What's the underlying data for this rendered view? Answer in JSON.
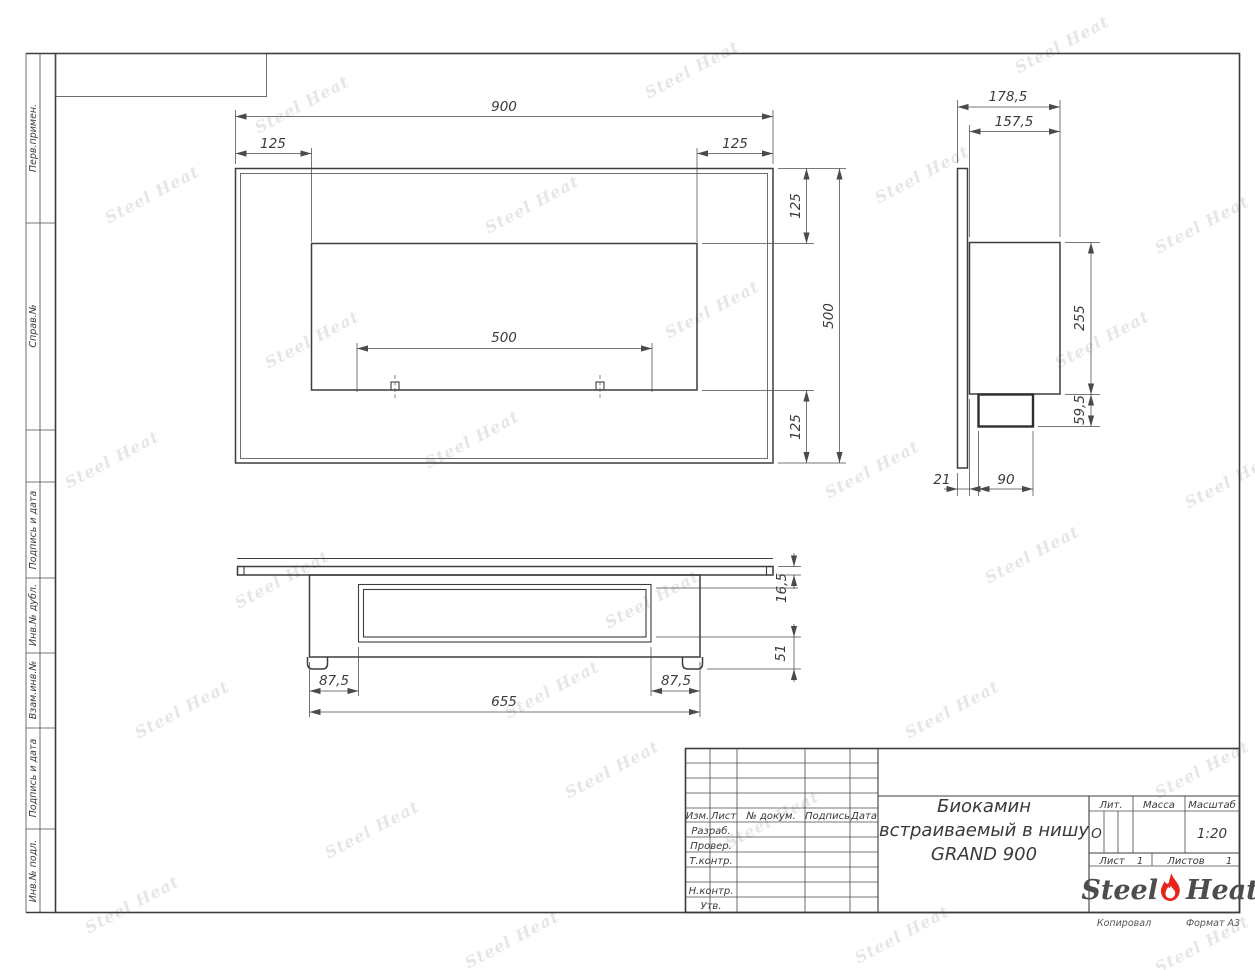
{
  "page": {
    "watermark_text": "Steel Heat",
    "accent_red": "#e8231c",
    "line_color": "#3d3d3d"
  },
  "margin_labels": [
    "Перв.примен.",
    "Справ.№",
    "Подпись и дата",
    "Инв.№ дубл.",
    "Взам.инв.№",
    "Подпись и дата",
    "Инв.№ подл."
  ],
  "footer": {
    "copied": "Копировал",
    "format": "Формат А3"
  },
  "title_block": {
    "headers": {
      "izm": "Изм.",
      "list": "Лист",
      "doc": "№ докум.",
      "sign": "Подпись",
      "date": "Дата"
    },
    "rows": [
      "Разраб.",
      "Провер.",
      "Т.контр.",
      "Н.контр.",
      "Утв."
    ],
    "title_line1": "Биокамин",
    "title_line2": "встраиваемый в нишу",
    "title_line3": "GRAND 900",
    "lit_label": "Лит.",
    "lit_value": "О",
    "mass_label": "Масса",
    "scale_label": "Масштаб",
    "scale_value": "1:20",
    "sheet_label": "Лист",
    "sheet_value": "1",
    "sheets_label": "Листов",
    "sheets_value": "1",
    "logo_steel": "Steel",
    "logo_heat": "Heat"
  },
  "dimensions": {
    "front": {
      "width": "900",
      "left_offset": "125",
      "right_offset": "125",
      "top_offset": "125",
      "height": "500",
      "bottom_offset": "125",
      "burner_span": "500"
    },
    "side": {
      "depth_total": "178,5",
      "depth_body": "157,5",
      "body_height": "255",
      "tray_height": "59,5",
      "panel_gap": "21",
      "tray_depth": "90"
    },
    "bottom": {
      "panel_thickness": "16,5",
      "tray_drop": "51",
      "inset_left": "87,5",
      "inset_right": "87,5",
      "body_width": "655"
    }
  }
}
